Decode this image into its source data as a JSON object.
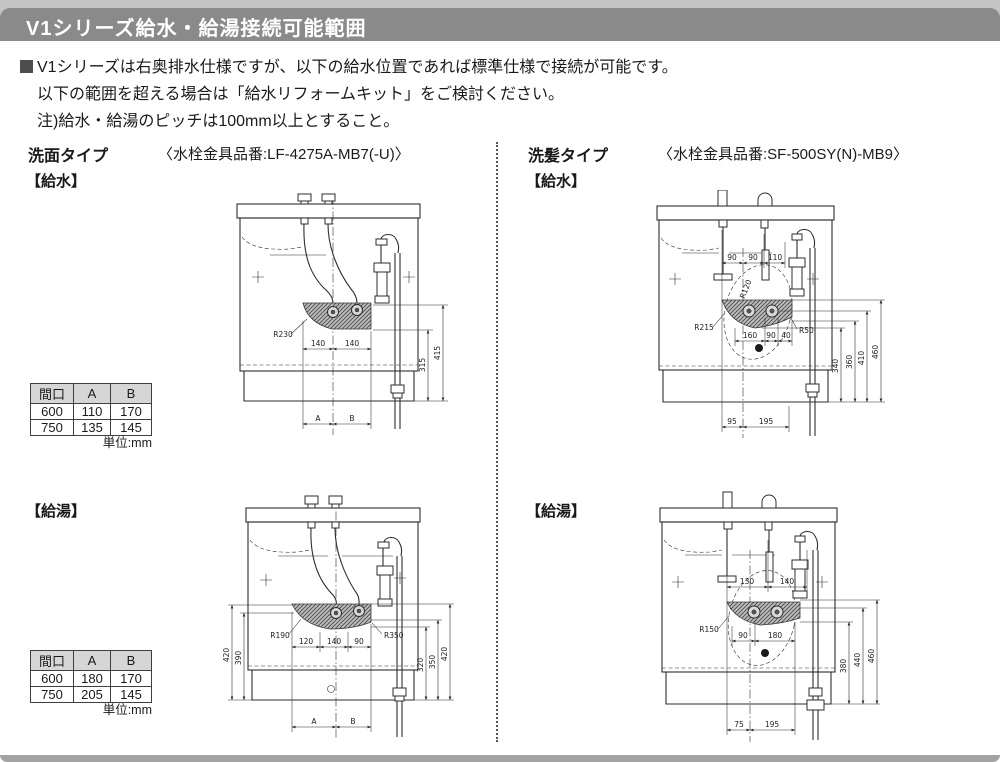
{
  "header": {
    "title": "V1シリーズ給水・給湯接続可能範囲"
  },
  "intro": {
    "line1": "V1シリーズは右奥排水仕様ですが、以下の給水位置であれば標準仕様で接続が可能です。",
    "line2": "以下の範囲を超える場合は「給水リフォームキット」をご検討ください。",
    "line3": "注)給水・給湯のピッチは100mm以上とすること。"
  },
  "washbasin": {
    "type_label": "洗面タイプ",
    "part_number": "〈水栓金具品番:LF-4275A-MB7(-U)〉",
    "supply_section": {
      "label": "【給水】",
      "diagram": {
        "radius": "R230",
        "pitch_left": "140",
        "pitch_right": "140",
        "height_inner": "315",
        "height_outer": "415",
        "dim_a": "A",
        "dim_b": "B"
      },
      "table": {
        "headers": [
          "間口",
          "A",
          "B"
        ],
        "rows": [
          [
            "600",
            "110",
            "170"
          ],
          [
            "750",
            "135",
            "145"
          ]
        ],
        "unit": "単位:mm"
      }
    },
    "hot_section": {
      "label": "【給湯】",
      "diagram": {
        "radius_left": "R190",
        "radius_right": "R350",
        "w1": "120",
        "w2": "140",
        "w3": "90",
        "left_outer": "420",
        "left_inner": "390",
        "right_inner": "320",
        "right_mid": "350",
        "right_outer": "420",
        "dim_a": "A",
        "dim_b": "B"
      },
      "table": {
        "headers": [
          "間口",
          "A",
          "B"
        ],
        "rows": [
          [
            "600",
            "180",
            "170"
          ],
          [
            "750",
            "205",
            "145"
          ]
        ],
        "unit": "単位:mm"
      }
    }
  },
  "shampoo": {
    "type_label": "洗髪タイプ",
    "part_number": "〈水栓金具品番:SF-500SY(N)-MB9〉",
    "supply_section": {
      "label": "【給水】",
      "diagram": {
        "top1": "90",
        "top2": "90",
        "top3": "110",
        "hose_radius": "R120",
        "radius_left": "R215",
        "radius_right": "R50",
        "w1": "160",
        "w2": "90",
        "w3": "40",
        "h1": "340",
        "h2": "360",
        "h3": "410",
        "h4": "460",
        "b1": "95",
        "b2": "195"
      }
    },
    "hot_section": {
      "label": "【給湯】",
      "diagram": {
        "top1": "130",
        "top2": "140",
        "radius_left": "R150",
        "w1": "90",
        "w2": "180",
        "h1": "380",
        "h2": "440",
        "h3": "460",
        "b1": "75",
        "b2": "195"
      }
    }
  }
}
